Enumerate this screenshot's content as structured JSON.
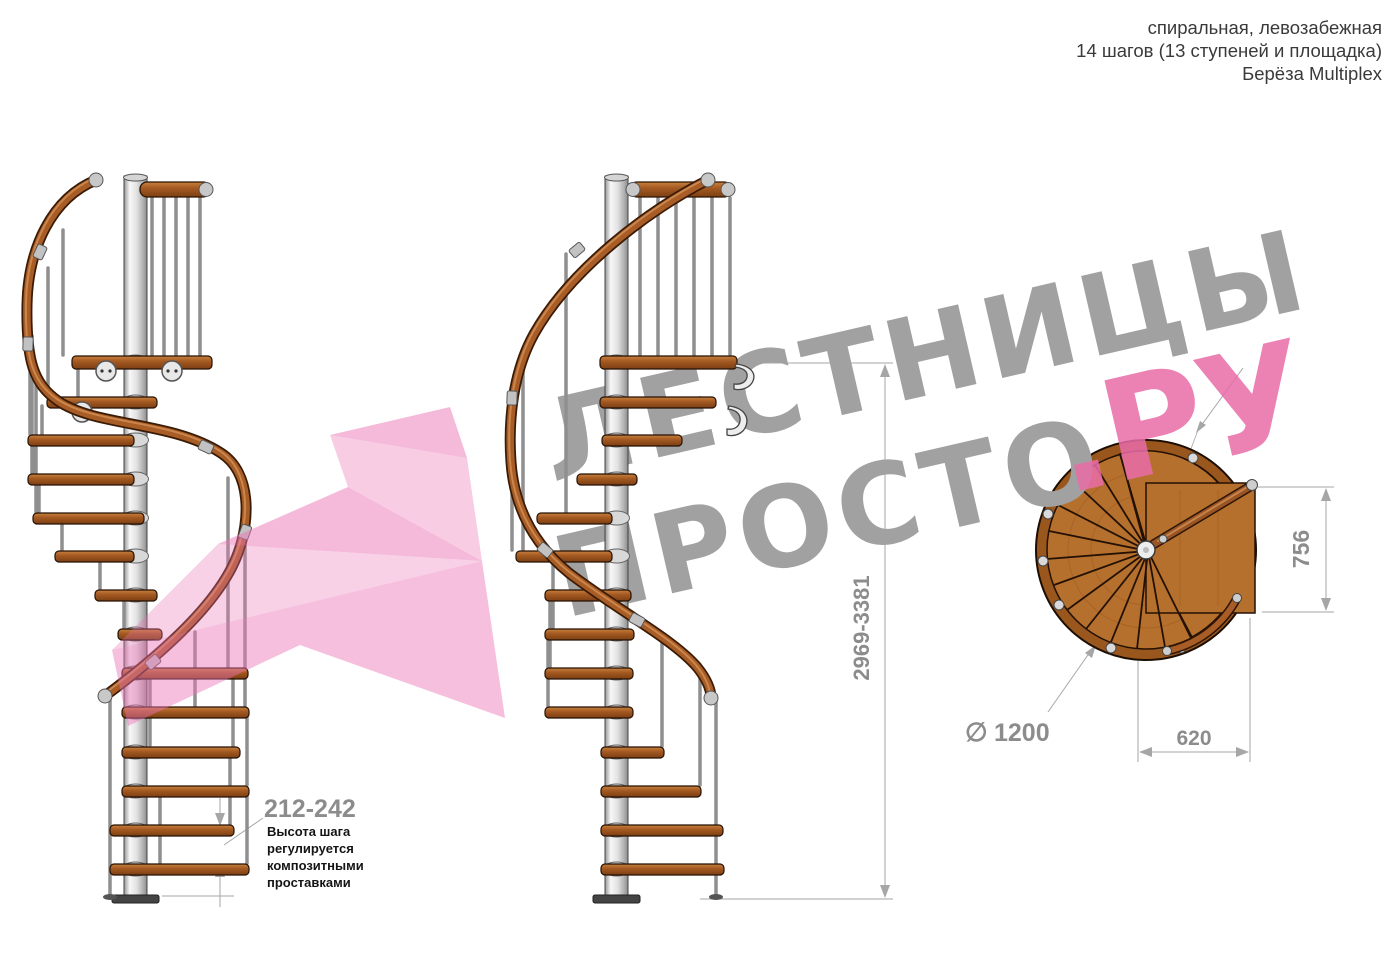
{
  "header": {
    "style_line": "спиральная, левозабежная",
    "steps_line": "14 шагов (13 ступеней и площадка)",
    "material_line": "Берёза Multiplex"
  },
  "watermark": {
    "word1": "ЛЕСТНИЦЫ",
    "word2": "ПРОСТО",
    "word2_suffix": ".РУ",
    "gray_color": "#a1a1a1",
    "accent_color": "#e96ca8",
    "logo_pink": "#ec74b5"
  },
  "dimensions": {
    "total_height": "2969-3381",
    "step_height_range": "212-242",
    "landing_depth": "756",
    "landing_width": "620",
    "diameter_symbol": "∅",
    "diameter_value": "1200"
  },
  "note": {
    "line1": "Высота шага",
    "line2": "регулируется",
    "line3": "композитными",
    "line4": "проставками"
  },
  "colors": {
    "wood": "#a55a22",
    "rail": "#a85c26",
    "metal": "#c9c9c9",
    "dimension": "#8c8c8c",
    "header_text": "#3a3a3a"
  }
}
